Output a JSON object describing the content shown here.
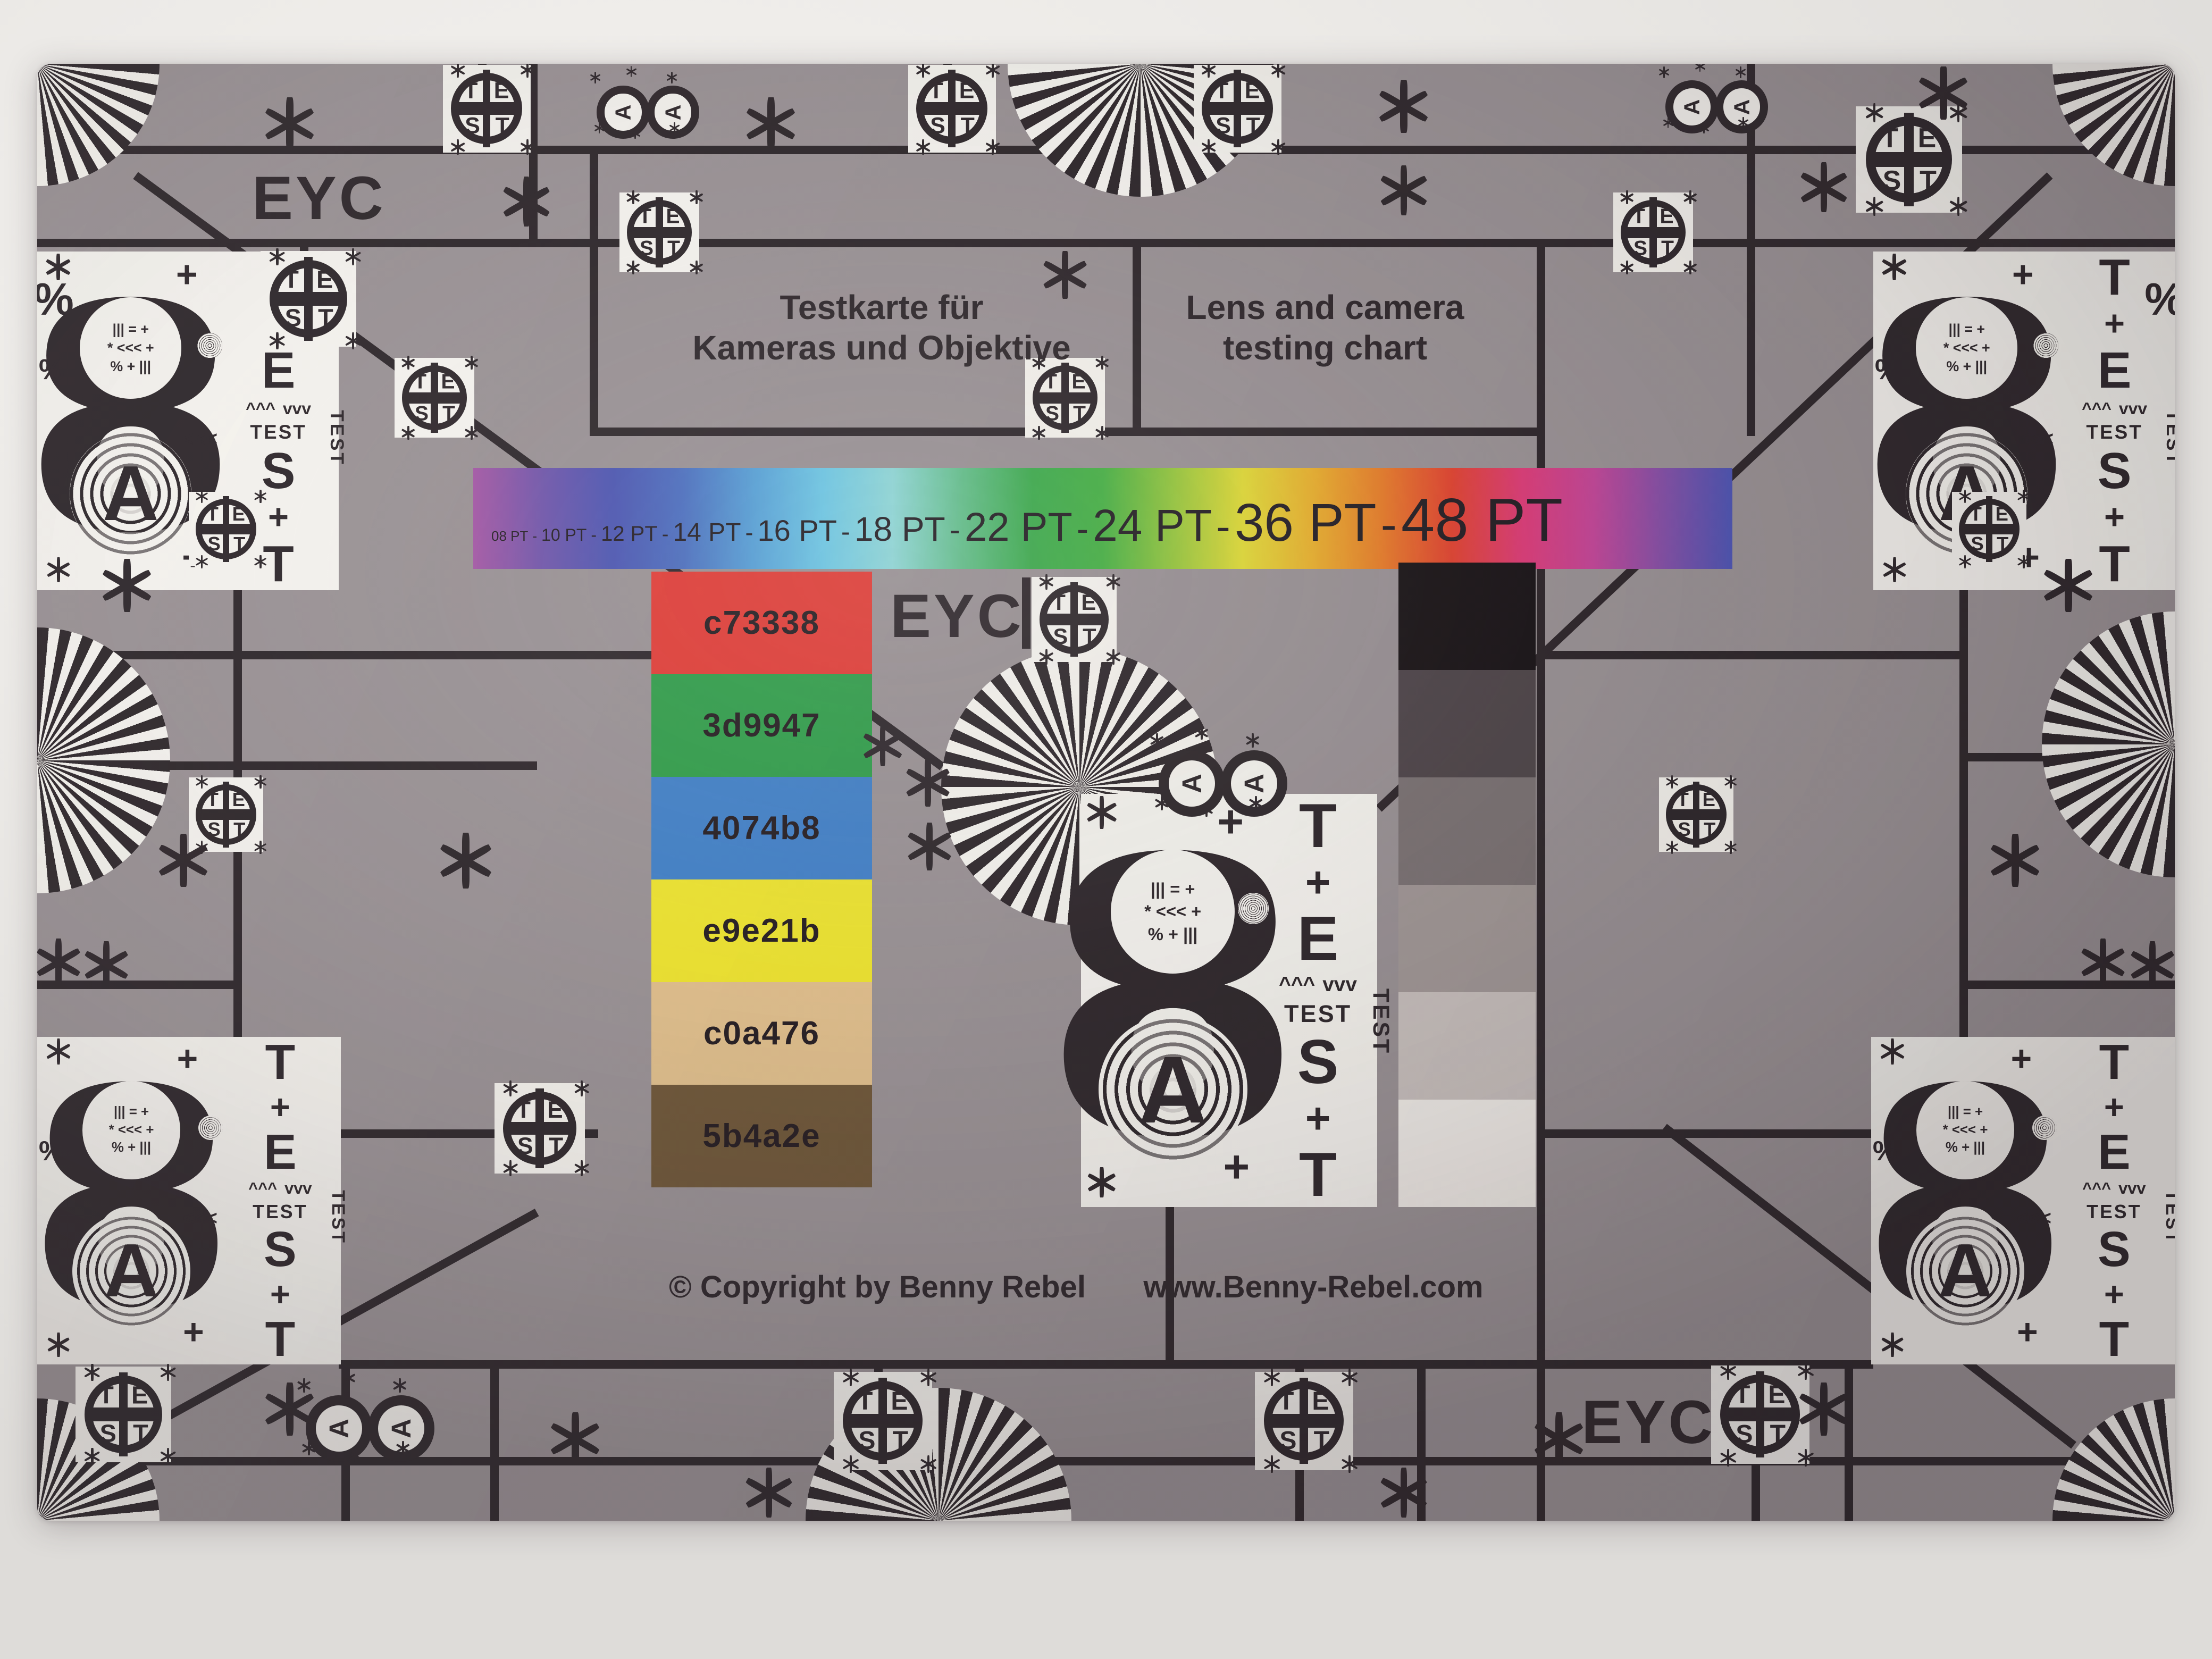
{
  "page_background": "#e9e7e4",
  "chart": {
    "colors": {
      "gray": "#9a9295",
      "line": "#2e272b",
      "white": "#f6f4ef"
    },
    "eyc_top_left": "EYC",
    "eyc_center": "EYC",
    "eyc_bottom_right": "EYC",
    "title_de_line1": "Testkarte für",
    "title_de_line2": "Kameras und Objektive",
    "title_en_line1": "Lens and camera",
    "title_en_line2": "testing chart",
    "copyright": "© Copyright by Benny Rebel",
    "website": "www.Benny-Rebel.com"
  },
  "rainbow": {
    "separator": "-",
    "labels": [
      {
        "text": "08 PT"
      },
      {
        "text": "10 PT"
      },
      {
        "text": "12 PT"
      },
      {
        "text": "14 PT"
      },
      {
        "text": "16 PT"
      },
      {
        "text": "18 PT"
      },
      {
        "text": "22 PT"
      },
      {
        "text": "24 PT"
      },
      {
        "text": "36 PT"
      },
      {
        "text": "48 PT"
      }
    ],
    "gradient": [
      "#a557a5",
      "#6f55ab",
      "#4b55b2",
      "#4b6fc0",
      "#55a0d8",
      "#6cc8e6",
      "#8fd8d8",
      "#62c08a",
      "#3cac4c",
      "#46b244",
      "#96c83c",
      "#e2dc36",
      "#eab02c",
      "#e87c28",
      "#e24230",
      "#de3c78",
      "#c44698",
      "#8650a8",
      "#4d55b5"
    ]
  },
  "swatches": [
    {
      "label": "c73338",
      "color": "#e23c36"
    },
    {
      "label": "3d9947",
      "color": "#2f9e49"
    },
    {
      "label": "4074b8",
      "color": "#4080c8"
    },
    {
      "label": "e9e21b",
      "color": "#efe52e"
    },
    {
      "label": "c0a476",
      "color": "#e2c08c"
    },
    {
      "label": "5b4a2e",
      "color": "#6e5637"
    }
  ],
  "grayscale": [
    "#1a1417",
    "#4f464a",
    "#7b7273",
    "#a19896",
    "#c9c1be",
    "#f2eee9"
  ],
  "glyphs": {
    "eight": "8",
    "letter_a": "A",
    "t": "T",
    "e": "E",
    "s": "S",
    "test": "TEST",
    "plus": "+",
    "percent": "%",
    "arrows_left": "<<<",
    "arrows_up": "^^^",
    "arrows_down": "vvv",
    "mini1": "||| = +",
    "mini2": "* <<< +",
    "mini3": "% + |||"
  },
  "icons": {
    "asterisk": "six-spoke-asterisk",
    "fan": "siemens-star-fan",
    "test_circle": "test-crosshair-circle",
    "rotated_eight": "rotated-eight-badge",
    "rings": "concentric-rings"
  }
}
